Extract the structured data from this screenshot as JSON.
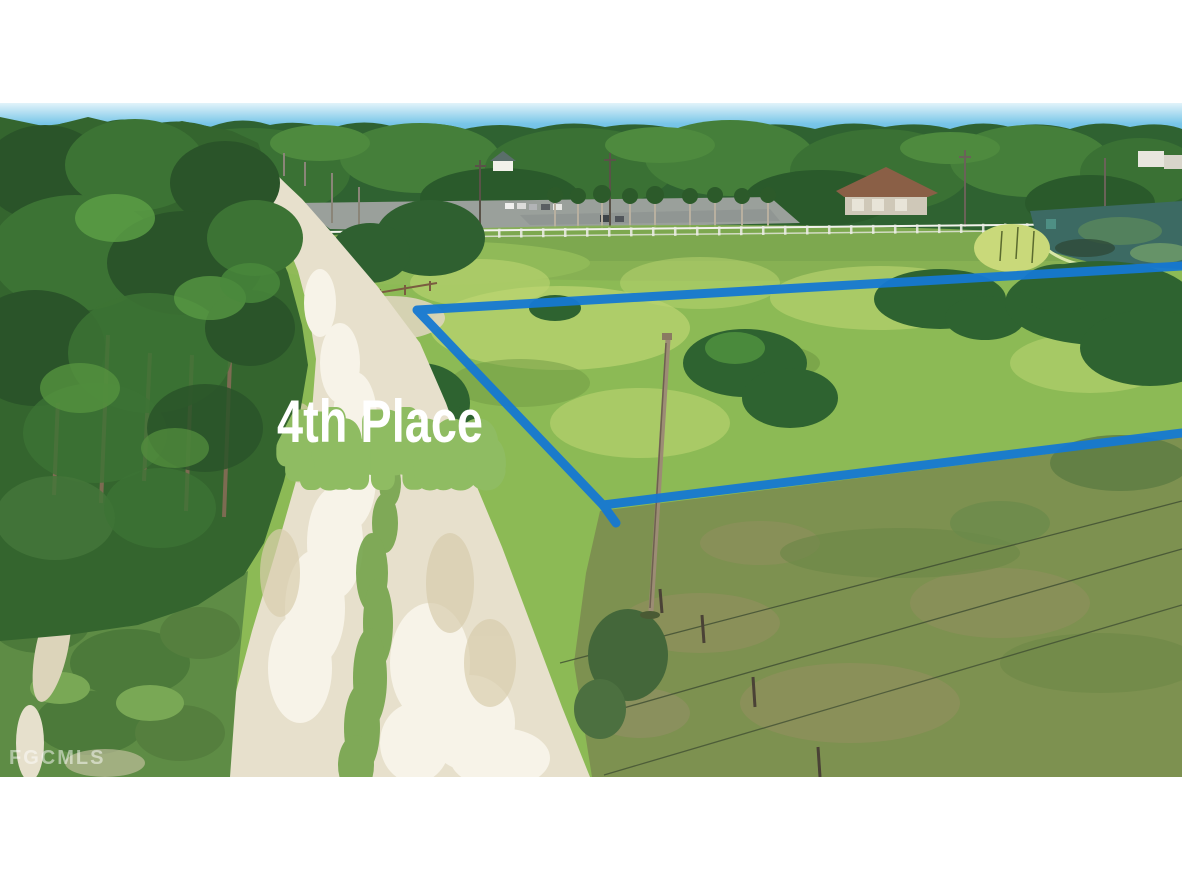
{
  "photo": {
    "kind": "aerial-drone-listing-photo",
    "overlay": {
      "street_label": "4th Place",
      "watermark": "FGCMLS"
    },
    "colors": {
      "boundary_line": "#1578d2",
      "street_label_bg": "#8fbc62",
      "street_label_text": "#ffffff",
      "watermark_text": "#ffffff",
      "sky": "#79c6e8",
      "letterbox": "#ffffff"
    }
  }
}
